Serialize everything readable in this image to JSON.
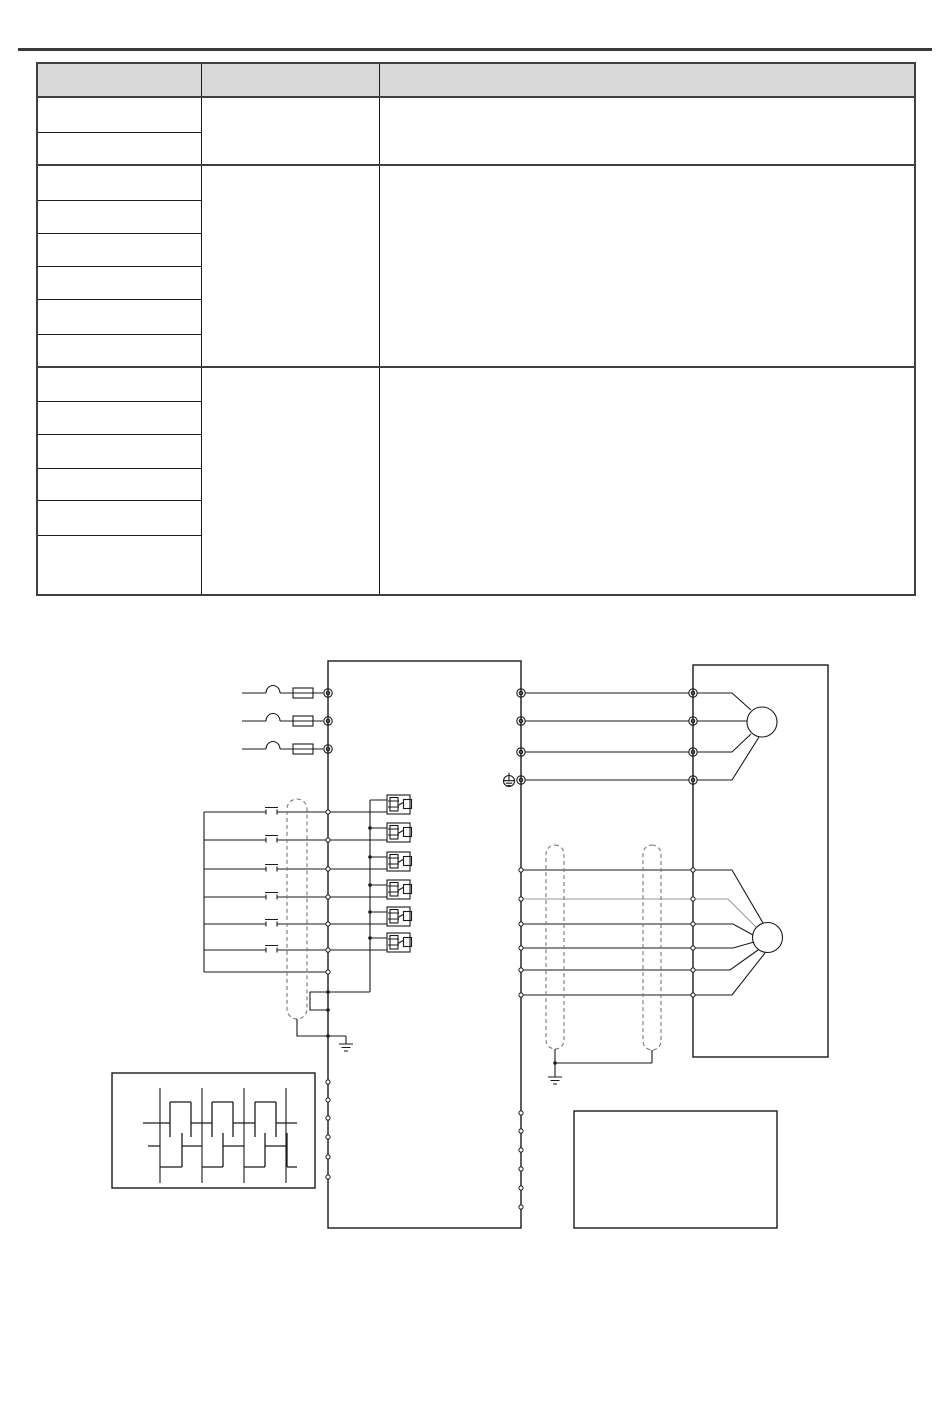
{
  "page": {
    "background": "#ffffff",
    "top_rule_color": "#3a3a3a"
  },
  "table": {
    "columns": 3,
    "border_color": "#3f3f3f",
    "grid_color": "#1a1a1a",
    "header": {
      "fill": "#d9d9d9",
      "cells": [
        "",
        "",
        ""
      ]
    },
    "sections": [
      {
        "col1_rows": 2,
        "col2_text": "",
        "col3_text": ""
      },
      {
        "col1_rows": 6,
        "col2_text": "",
        "col3_text": ""
      },
      {
        "col1_rows": 6,
        "col2_text": "",
        "col3_text": ""
      }
    ]
  },
  "diagram": {
    "line_color": "#1a1a1a",
    "shield_dash_color": "#777777",
    "faint_wire_color": "#9a9a9a",
    "mains_input_lines": 3,
    "motor_power_wires": 4,
    "control_input_lines": 6,
    "encoder_feedback_wires": 6,
    "left_connector_pins": 6,
    "right_connector_pins": 6,
    "pulse_waveform_traces": 2,
    "ground_symbols": 3
  }
}
